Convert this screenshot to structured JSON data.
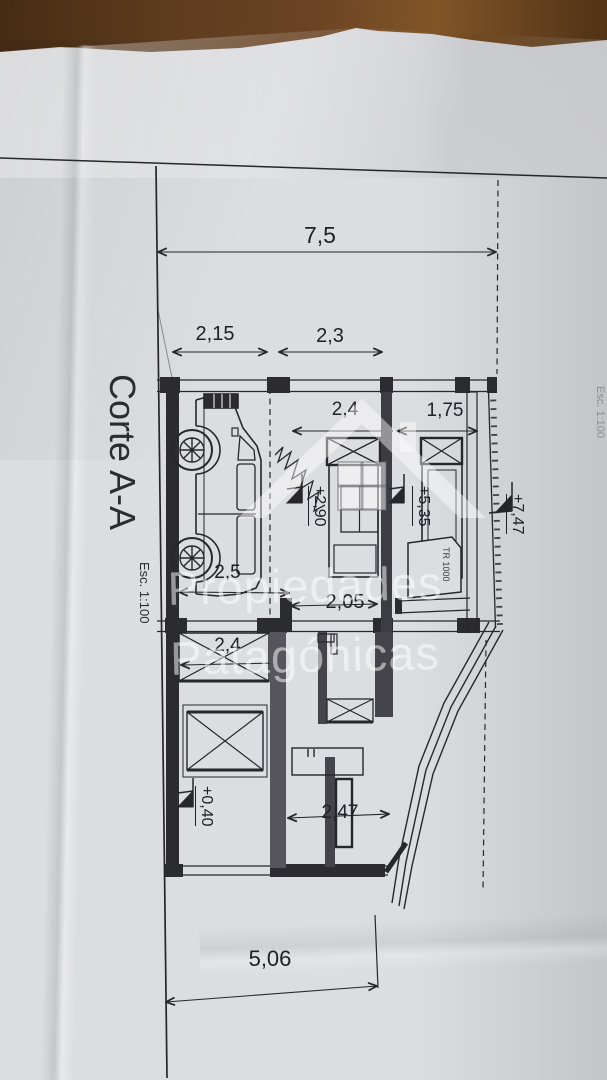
{
  "scene": {
    "background": "photo of a creased architectural plan sheet on a wooden table",
    "wood_color": "#5e3c1e",
    "paper_color": "#dcdde1",
    "ink_color": "#26262b",
    "watermark_color": "rgba(255,255,255,0.52)"
  },
  "drawing": {
    "title": "Corte A-A",
    "scale_label": "Esc. 1:100",
    "edge_text": "Esc. 1:100",
    "tank_label": "TR 1000",
    "dimensions": [
      {
        "id": "overall-width",
        "label": "7,5"
      },
      {
        "id": "left-span",
        "label": "2,15"
      },
      {
        "id": "right-span",
        "label": "2,3"
      },
      {
        "id": "room-24-upper",
        "label": "2,4"
      },
      {
        "id": "room-175",
        "label": "1,75"
      },
      {
        "id": "garage-depth",
        "label": "2,5"
      },
      {
        "id": "landing",
        "label": "2,05"
      },
      {
        "id": "room-24-lower",
        "label": "2,4"
      },
      {
        "id": "room-247",
        "label": "2,47"
      },
      {
        "id": "lower-span",
        "label": "5,06"
      }
    ],
    "levels": [
      {
        "id": "level-290",
        "label": "+2,90"
      },
      {
        "id": "level-535",
        "label": "+5,35"
      },
      {
        "id": "level-747",
        "label": "+7,47"
      },
      {
        "id": "level-040",
        "label": "+0,40"
      }
    ]
  },
  "watermark": {
    "line1": "Propiedades",
    "line2": "Patagónicas"
  }
}
